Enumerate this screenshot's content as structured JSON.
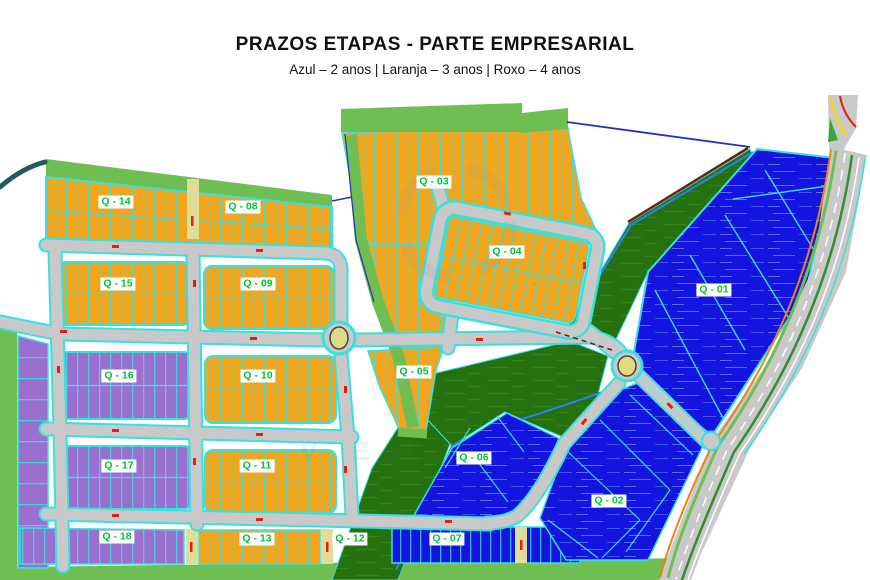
{
  "header": {
    "title": "PRAZOS ETAPAS - PARTE EMPRESARIAL",
    "subtitle": "Azul – 2 anos | Laranja – 3 anos | Roxo – 4 anos"
  },
  "legend": [
    {
      "color_name": "Azul",
      "term": "2 anos"
    },
    {
      "color_name": "Laranja",
      "term": "3 anos"
    },
    {
      "color_name": "Roxo",
      "term": "4 anos"
    }
  ],
  "colors": {
    "azul": "#1414e0",
    "laranja": "#f2a61e",
    "roxo": "#9b6fd0",
    "verde_escuro": "#25700f",
    "verde_claro": "#6fbe52",
    "road_gray": "#c9c9c9",
    "road_edge_cyan": "#38e0e0",
    "label_green": "#00c13a",
    "mark_red": "#e02010"
  },
  "watermark": {
    "text": "V E I S"
  },
  "blocks": [
    {
      "id": "q14",
      "label": "Q - 14",
      "zone": "laranja",
      "x": 116,
      "y": 202
    },
    {
      "id": "q08",
      "label": "Q - 08",
      "zone": "laranja",
      "x": 243,
      "y": 207
    },
    {
      "id": "q03",
      "label": "Q - 03",
      "zone": "laranja",
      "x": 434,
      "y": 182
    },
    {
      "id": "q04",
      "label": "Q - 04",
      "zone": "laranja",
      "x": 507,
      "y": 252
    },
    {
      "id": "q15",
      "label": "Q - 15",
      "zone": "laranja",
      "x": 118,
      "y": 284
    },
    {
      "id": "q09",
      "label": "Q - 09",
      "zone": "laranja",
      "x": 258,
      "y": 284
    },
    {
      "id": "q01",
      "label": "Q - 01",
      "zone": "azul",
      "x": 714,
      "y": 290
    },
    {
      "id": "q16",
      "label": "Q - 16",
      "zone": "roxo",
      "x": 119,
      "y": 376
    },
    {
      "id": "q10",
      "label": "Q - 10",
      "zone": "laranja",
      "x": 258,
      "y": 376
    },
    {
      "id": "q05",
      "label": "Q - 05",
      "zone": "laranja",
      "x": 414,
      "y": 372
    },
    {
      "id": "q17",
      "label": "Q - 17",
      "zone": "roxo",
      "x": 119,
      "y": 466
    },
    {
      "id": "q11",
      "label": "Q - 11",
      "zone": "laranja",
      "x": 257,
      "y": 466
    },
    {
      "id": "q06",
      "label": "Q - 06",
      "zone": "azul",
      "x": 474,
      "y": 458
    },
    {
      "id": "q02",
      "label": "Q - 02",
      "zone": "azul",
      "x": 609,
      "y": 501
    },
    {
      "id": "q18",
      "label": "Q - 18",
      "zone": "roxo",
      "x": 117,
      "y": 537
    },
    {
      "id": "q13",
      "label": "Q - 13",
      "zone": "laranja",
      "x": 257,
      "y": 539
    },
    {
      "id": "q12",
      "label": "Q - 12",
      "zone": "verde",
      "x": 350,
      "y": 539
    },
    {
      "id": "q07",
      "label": "Q - 07",
      "zone": "azul",
      "x": 447,
      "y": 539
    }
  ]
}
